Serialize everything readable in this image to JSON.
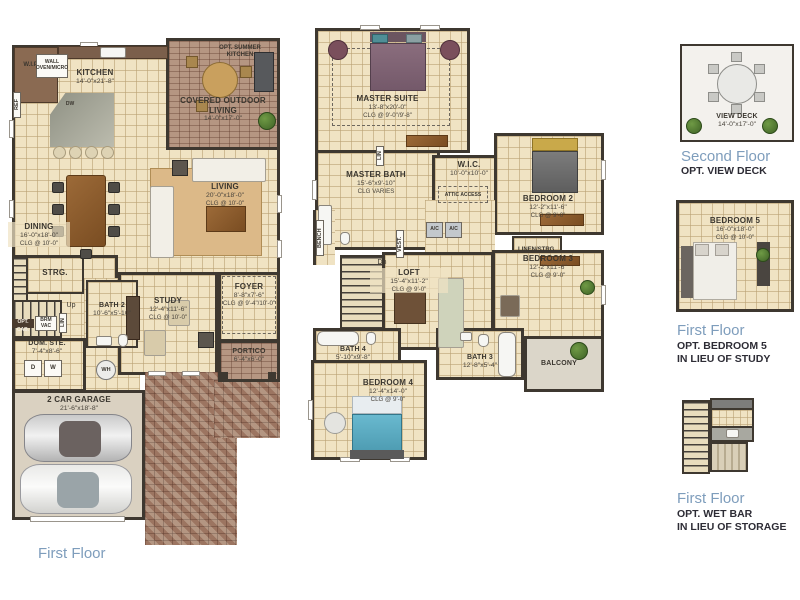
{
  "colors": {
    "wall": "#3e3830",
    "tile_floor": "#f0e3c3",
    "brick_paver": "#b59682",
    "caption_blue": "#7e9dbc",
    "caption_dark": "#2d2c35",
    "plant_green": "#4e7a33"
  },
  "first_floor": {
    "caption": "First Floor",
    "rooms": {
      "kitchen": {
        "name": "KITCHEN",
        "dims": "14'-0\"x21'-8\""
      },
      "covered_outdoor_living": {
        "name": "COVERED OUTDOOR LIVING",
        "dims": "14'-0\"x17'-0\""
      },
      "opt_summer_kitchen": {
        "name": "OPT. SUMMER KITCHEN"
      },
      "living": {
        "name": "LIVING",
        "dims": "20'-0\"x18'-0\"",
        "clg": "CLG @ 10'-0\""
      },
      "dining": {
        "name": "DINING",
        "dims": "16'-0\"x18'-0\"",
        "clg": "CLG @ 10'-0\""
      },
      "study": {
        "name": "STUDY",
        "dims": "12'-4\"x11'-6\"",
        "clg": "CLG @ 10'-0\""
      },
      "foyer": {
        "name": "FOYER",
        "dims": "8'-8\"x7'-6\"",
        "clg": "CLG @ 9'-4\"/10'-0\""
      },
      "portico": {
        "name": "PORTICO",
        "dims": "6'-4\"x6'-0\""
      },
      "garage": {
        "name": "2 CAR GARAGE",
        "dims": "21'-6\"x18'-8\""
      },
      "strg": {
        "name": "STRG."
      },
      "bath2": {
        "name": "BATH 2",
        "dims": "10'-6\"x5'-10\""
      },
      "dom_ste": {
        "name": "DOM. STE.",
        "dims": "7'-4\"x8'-6\""
      },
      "wip": {
        "name": "W.I.P."
      },
      "wall_oven": {
        "name": "WALL OVEN/MICRO"
      },
      "ref": {
        "name": "REF"
      },
      "dw": {
        "name": "DW"
      },
      "up": {
        "name": "Up"
      },
      "opt_cab": {
        "name": "OPT. CAB."
      },
      "brm_vac": {
        "name": "BRM VAC"
      },
      "lin": {
        "name": "LIN"
      },
      "washer": {
        "name": "W"
      },
      "dryer": {
        "name": "D"
      },
      "wh": {
        "name": "WH"
      }
    }
  },
  "second_floor": {
    "rooms": {
      "master_suite": {
        "name": "MASTER SUITE",
        "dims": "13'-8\"x20'-0\"",
        "clg": "CLG @ 9'-0\"/9'-8\""
      },
      "master_bath": {
        "name": "MASTER BATH",
        "dims": "15'-6\"x9'-10\"",
        "clg": "CLG VARIES"
      },
      "wic": {
        "name": "W.I.C.",
        "dims": "10'-0\"x10'-0\""
      },
      "attic_access": {
        "name": "ATTIC ACCESS"
      },
      "loft": {
        "name": "LOFT",
        "dims": "15'-4\"x11'-2\"",
        "clg": "CLG @ 9'-0\""
      },
      "bedroom2": {
        "name": "BEDROOM 2",
        "dims": "12'-2\"x11'-6\"",
        "clg": "CLG @ 9'-0\""
      },
      "bedroom3": {
        "name": "BEDROOM 3",
        "dims": "12'-2\"x11'-6\"",
        "clg": "CLG @ 9'-0\""
      },
      "bedroom4": {
        "name": "BEDROOM 4",
        "dims": "12'-4\"x14'-0\"",
        "clg": "CLG @ 9'-0\""
      },
      "bath3": {
        "name": "BATH 3",
        "dims": "12'-8\"x5'-4\""
      },
      "bath4": {
        "name": "BATH 4",
        "dims": "5'-10\"x9'-8\""
      },
      "balcony": {
        "name": "BALCONY"
      },
      "linen_strg": {
        "name": "LINEN/STRG."
      },
      "ac1": {
        "name": "A/C"
      },
      "ac2": {
        "name": "A/C"
      },
      "bench": {
        "name": "BENCH"
      },
      "vest": {
        "name": "VEST."
      },
      "lin": {
        "name": "LIN"
      },
      "dn": {
        "name": "Dn"
      }
    }
  },
  "options": {
    "view_deck": {
      "room": "VIEW DECK",
      "dims": "14'-0\"x17'-0\"",
      "floor": "Second Floor",
      "opt": "OPT. VIEW DECK"
    },
    "bedroom5": {
      "room": "BEDROOM 5",
      "dims": "16'-0\"x18'-0\"",
      "clg": "CLG @ 10'-0\"",
      "floor": "First Floor",
      "opt": "OPT. BEDROOM 5",
      "opt2": "IN LIEU OF STUDY"
    },
    "wet_bar": {
      "floor": "First Floor",
      "opt": "OPT. WET BAR",
      "opt2": "IN LIEU OF STORAGE"
    }
  }
}
